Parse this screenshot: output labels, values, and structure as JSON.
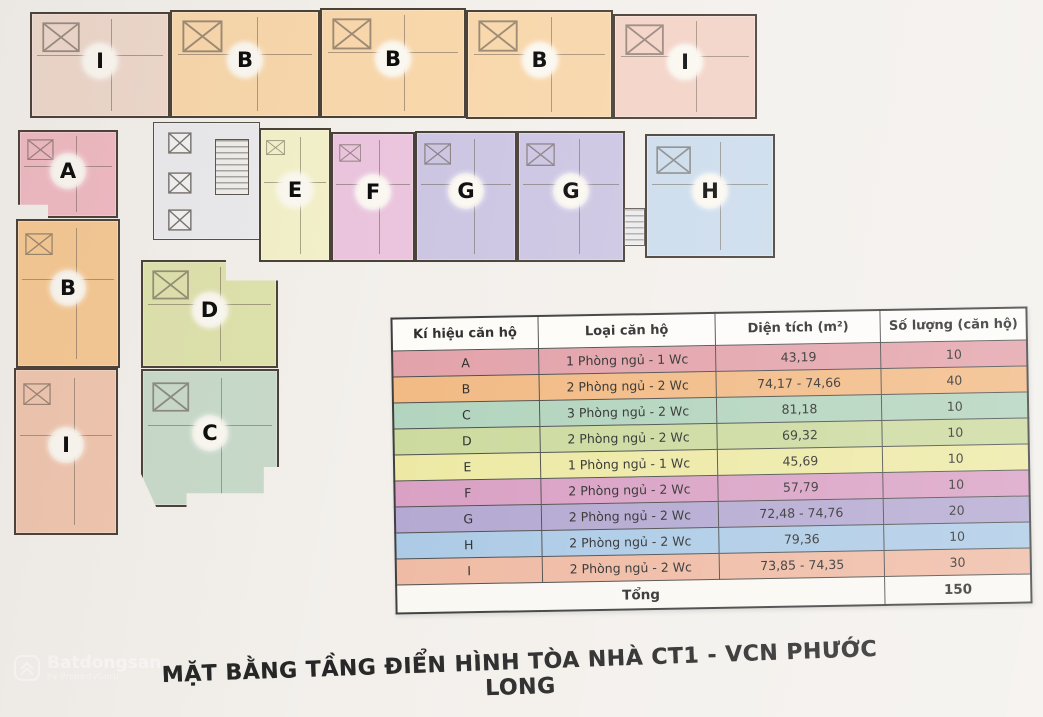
{
  "title": "MẶT BẰNG TẦNG ĐIỂN HÌNH TÒA NHÀ CT1 - VCN PHƯỚC LONG",
  "watermark": {
    "brand": "Batdongsan",
    "sub": "by PropertyGuru"
  },
  "table": {
    "headers": [
      "Kí hiệu căn hộ",
      "Loại căn hộ",
      "Diện tích (m²)",
      "Số lượng (căn hộ)"
    ],
    "rows": [
      {
        "code": "A",
        "type": "1 Phòng ngủ - 1 Wc",
        "area": "43,19",
        "qty": "10",
        "color": "#e3a2aa"
      },
      {
        "code": "B",
        "type": "2 Phòng ngủ - 2 Wc",
        "area": "74,17 - 74,66",
        "qty": "40",
        "color": "#f2ba84"
      },
      {
        "code": "C",
        "type": "3 Phòng ngủ - 2 Wc",
        "area": "81,18",
        "qty": "10",
        "color": "#b2d4bd"
      },
      {
        "code": "D",
        "type": "2 Phòng ngủ - 2 Wc",
        "area": "69,32",
        "qty": "10",
        "color": "#ccda9e"
      },
      {
        "code": "E",
        "type": "1 Phòng ngủ - 1 Wc",
        "area": "45,69",
        "qty": "10",
        "color": "#ede9a4"
      },
      {
        "code": "F",
        "type": "2 Phòng ngủ - 2 Wc",
        "area": "57,79",
        "qty": "10",
        "color": "#d9a0c4"
      },
      {
        "code": "G",
        "type": "2 Phòng ngủ - 2 Wc",
        "area": "72,48 - 74,76",
        "qty": "20",
        "color": "#b3a8d1"
      },
      {
        "code": "H",
        "type": "2 Phòng ngủ - 2 Wc",
        "area": "79,36",
        "qty": "10",
        "color": "#accae6"
      },
      {
        "code": "I",
        "type": "2 Phòng ngủ - 2 Wc",
        "area": "73,85 - 74,35",
        "qty": "30",
        "color": "#efbaa3"
      }
    ],
    "total_label": "Tổng",
    "total_qty": "150"
  },
  "floorplan": {
    "units": [
      {
        "label": "I",
        "x": 30,
        "y": 12,
        "w": 140,
        "h": 106,
        "color": "#eed8cc"
      },
      {
        "label": "B",
        "x": 170,
        "y": 10,
        "w": 150,
        "h": 108,
        "color": "#f8d7ab"
      },
      {
        "label": "B",
        "x": 320,
        "y": 8,
        "w": 146,
        "h": 110,
        "color": "#f8d7ab"
      },
      {
        "label": "B",
        "x": 466,
        "y": 10,
        "w": 147,
        "h": 109,
        "color": "#f8d7ab"
      },
      {
        "label": "I",
        "x": 613,
        "y": 14,
        "w": 144,
        "h": 105,
        "color": "#f3d3c7"
      },
      {
        "label": "A",
        "x": 18,
        "y": 130,
        "w": 100,
        "h": 88,
        "color": "#f0bac3",
        "clip": "polygon(0 0,100% 0,100% 100%,30% 100%,30% 85%,0 85%)"
      },
      {
        "label": "",
        "x": 153,
        "y": 122,
        "w": 107,
        "h": 118,
        "color": "#eaeaed",
        "kind": "core"
      },
      {
        "label": "E",
        "x": 259,
        "y": 128,
        "w": 72,
        "h": 134,
        "color": "#f3f1c9"
      },
      {
        "label": "F",
        "x": 331,
        "y": 132,
        "w": 84,
        "h": 130,
        "color": "#eac5dd"
      },
      {
        "label": "G",
        "x": 415,
        "y": 131,
        "w": 102,
        "h": 131,
        "color": "#cdc6e3"
      },
      {
        "label": "G",
        "x": 517,
        "y": 131,
        "w": 108,
        "h": 131,
        "color": "#cdc6e3"
      },
      {
        "label": "",
        "x": 624,
        "y": 208,
        "w": 21,
        "h": 38,
        "color": "#ececee",
        "kind": "stairs"
      },
      {
        "label": "H",
        "x": 645,
        "y": 134,
        "w": 130,
        "h": 124,
        "color": "#ccdcec"
      },
      {
        "label": "B",
        "x": 16,
        "y": 219,
        "w": 104,
        "h": 149,
        "color": "#f6c994"
      },
      {
        "label": "I",
        "x": 14,
        "y": 368,
        "w": 104,
        "h": 167,
        "color": "#f0c6af"
      },
      {
        "label": "D",
        "x": 141,
        "y": 260,
        "w": 137,
        "h": 108,
        "color": "#dee2ac",
        "clip": "polygon(0 0,62% 0,62% 19%,100% 19%,100% 100%,0 100%)"
      },
      {
        "label": "C",
        "x": 141,
        "y": 369,
        "w": 138,
        "h": 138,
        "color": "#c8daca",
        "clip": "polygon(0 0,100% 0,100% 71%,89% 71%,89% 90%,33% 90%,33% 100%,11% 100%,0 76%)"
      }
    ]
  }
}
